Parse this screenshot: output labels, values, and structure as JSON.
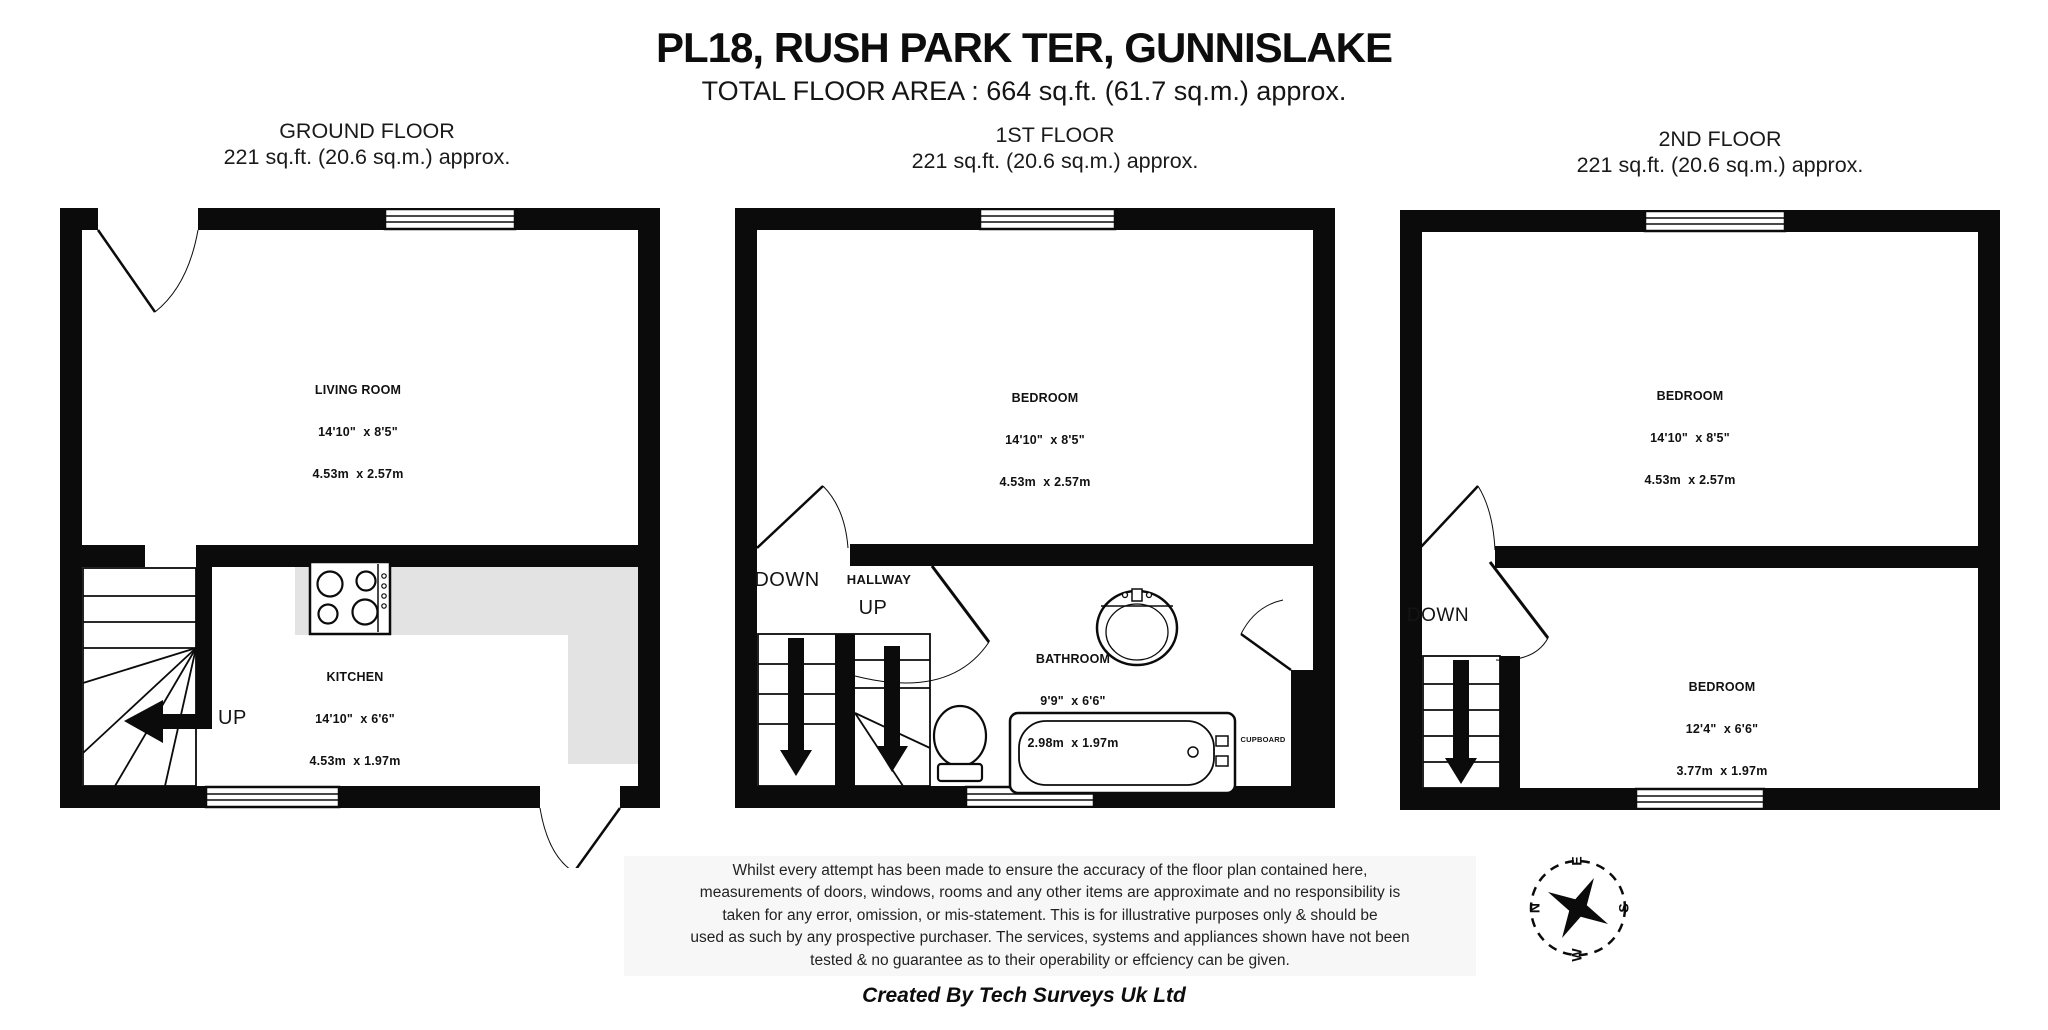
{
  "header": {
    "title": "PL18, RUSH PARK TER, GUNNISLAKE",
    "total_area": "TOTAL FLOOR AREA : 664 sq.ft. (61.7 sq.m.) approx."
  },
  "floors": [
    {
      "name": "GROUND FLOOR",
      "area": "221 sq.ft. (20.6 sq.m.) approx.",
      "rooms": [
        {
          "name": "LIVING ROOM",
          "imperial": "14'10\"  x 8'5\"",
          "metric": "4.53m  x 2.57m"
        },
        {
          "name": "KITCHEN",
          "imperial": "14'10\"  x 6'6\"",
          "metric": "4.53m  x 1.97m"
        }
      ],
      "labels": {
        "up": "UP"
      }
    },
    {
      "name": "1ST FLOOR",
      "area": "221 sq.ft. (20.6 sq.m.) approx.",
      "rooms": [
        {
          "name": "BEDROOM",
          "imperial": "14'10\"  x 8'5\"",
          "metric": "4.53m  x 2.57m"
        },
        {
          "name": "BATHROOM",
          "imperial": "9'9\"  x 6'6\"",
          "metric": "2.98m  x 1.97m"
        }
      ],
      "labels": {
        "down": "DOWN",
        "hallway": "HALLWAY",
        "up": "UP",
        "cupboard": "CUPBOARD"
      }
    },
    {
      "name": "2ND FLOOR",
      "area": "221 sq.ft. (20.6 sq.m.) approx.",
      "rooms": [
        {
          "name": "BEDROOM",
          "imperial": "14'10\"  x 8'5\"",
          "metric": "4.53m  x 2.57m"
        },
        {
          "name": "BEDROOM",
          "imperial": "12'4\"  x 6'6\"",
          "metric": "3.77m  x 1.97m"
        }
      ],
      "labels": {
        "down": "DOWN"
      }
    }
  ],
  "footer": {
    "disclaimer_lines": [
      "Whilst every attempt has been made to ensure the accuracy of the floor plan contained here,",
      "measurements of doors, windows, rooms and any other items are approximate and no responsibility is",
      "taken for any error, omission, or mis-statement. This is for illustrative purposes only & should be",
      "used as such by any prospective purchaser. The services, systems and appliances shown have not been",
      "tested & no guarantee as to their operability or effciency can be given."
    ],
    "credit": "Created By Tech Surveys Uk Ltd"
  },
  "compass": {
    "n": "N",
    "e": "E",
    "s": "S",
    "w": "W"
  },
  "colors": {
    "wall": "#0b0b0b",
    "counter": "#e3e3e3"
  }
}
